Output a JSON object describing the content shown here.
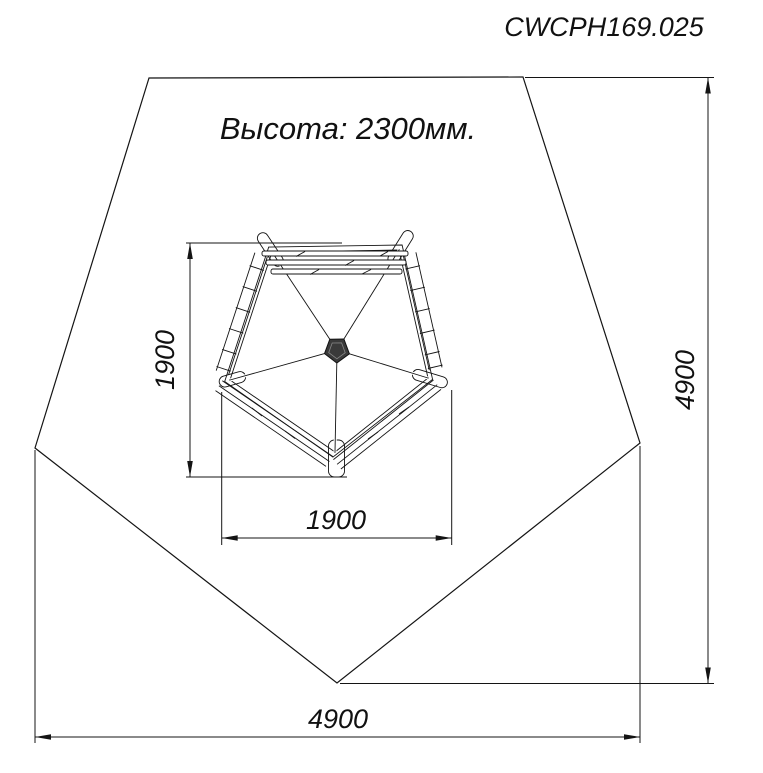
{
  "title": "CWCPH169.025",
  "note": {
    "height_label": "Высота: 2300мм."
  },
  "dimensions": {
    "structure_depth": "1900",
    "structure_width": "1900",
    "safety_zone_depth": "4900",
    "safety_zone_width": "4900"
  },
  "colors": {
    "line": "#141414",
    "background": "#ffffff"
  }
}
